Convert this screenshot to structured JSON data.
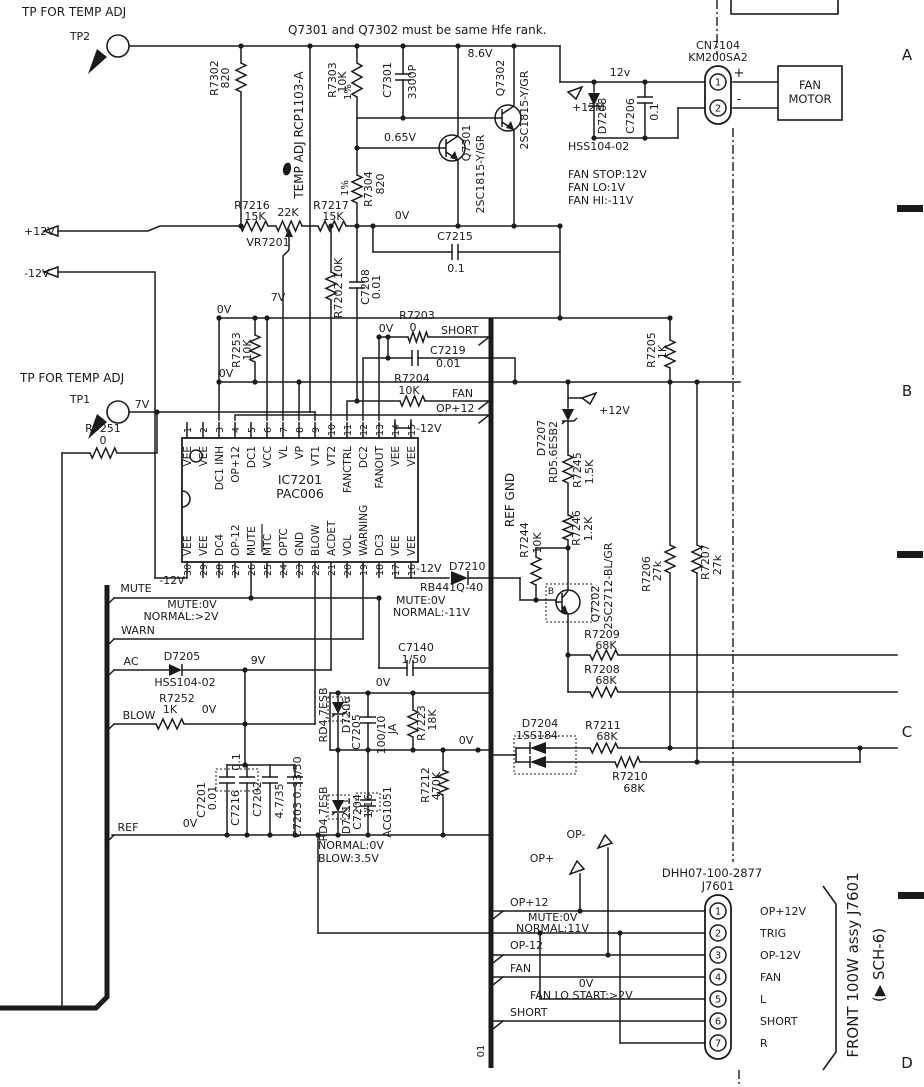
{
  "schematic": {
    "note": "Q7301 and Q7302 must be same Hfe rank.",
    "zones": [
      "A",
      "B",
      "C",
      "D"
    ]
  },
  "ic7201": {
    "ref": "IC7201",
    "part": "PAC006",
    "pin_numbers_top": [
      "1",
      "2",
      "3",
      "4",
      "5",
      "6",
      "7",
      "8",
      "9",
      "10",
      "11",
      "12",
      "13",
      "14",
      "15"
    ],
    "pins_top": [
      "VEE",
      "VEE",
      "DC1 INH",
      "OP+12",
      "DC1",
      "VCC",
      "VL",
      "VP",
      "VT1",
      "VT2",
      "FANCTRL",
      "DC2",
      "FANOUT",
      "VEE",
      "VEE"
    ],
    "pin_numbers_bottom": [
      "30",
      "29",
      "28",
      "27",
      "26",
      "25",
      "24",
      "23",
      "22",
      "21",
      "20",
      "19",
      "18",
      "17",
      "16"
    ],
    "pins_bottom": [
      "VEE",
      "VEE",
      "DC4",
      "OP-12",
      "MUTE",
      "MTC",
      "OPTC",
      "GND",
      "BLOW",
      "ACDET",
      "VOL",
      "WARNING",
      "DC3",
      "VEE",
      "VEE"
    ]
  },
  "connectors": {
    "cn7104": {
      "name": "CN7104",
      "part": "KM200SA2",
      "pins": [
        {
          "num": "1",
          "polarity": "+"
        },
        {
          "num": "2",
          "polarity": "-"
        }
      ],
      "load_lines": [
        "FAN",
        "MOTOR"
      ]
    },
    "j7601": {
      "name": "J7601",
      "part": "DHH07-100-2877",
      "pins": [
        {
          "num": "1",
          "label": "OP+12V"
        },
        {
          "num": "2",
          "label": "TRIG"
        },
        {
          "num": "3",
          "label": "OP-12V"
        },
        {
          "num": "4",
          "label": "FAN"
        },
        {
          "num": "5",
          "label": "L"
        },
        {
          "num": "6",
          "label": "SHORT"
        },
        {
          "num": "7",
          "label": "R"
        },
        {
          "num": "",
          "label": ""
        }
      ],
      "assy_note": "FRONT 100W assy J7601",
      "sch_ref": "(▶ SCH-6)"
    }
  },
  "labels": [
    {
      "name": "tp-top-caption",
      "text": "TP FOR TEMP ADJ",
      "x": 22,
      "y": 16,
      "a": "s",
      "s": 12
    },
    {
      "name": "tp2",
      "text": "TP2",
      "x": 80,
      "y": 40
    },
    {
      "name": "hfe-note",
      "text": "Q7301 and Q7302 must be same Hfe rank.",
      "x": 288,
      "y": 34,
      "a": "s",
      "s": 12
    },
    {
      "name": "r7302",
      "text": "R7302",
      "x": 218,
      "y": 78,
      "r": -90
    },
    {
      "name": "r7302-value",
      "text": "820",
      "x": 229,
      "y": 78,
      "r": -90
    },
    {
      "name": "temp-adj",
      "text": "TEMP ADJ RCP1103-A",
      "x": 303,
      "y": 135,
      "r": -90,
      "s": 12
    },
    {
      "name": "r7303",
      "text": "R7303",
      "x": 336,
      "y": 80,
      "r": -90
    },
    {
      "name": "r7303-value",
      "text": "10K",
      "x": 346,
      "y": 82,
      "r": -90
    },
    {
      "name": "r7303-tol",
      "text": "1%",
      "x": 351,
      "y": 92,
      "r": -90,
      "s": 10
    },
    {
      "name": "c7301",
      "text": "C7301",
      "x": 391,
      "y": 80,
      "r": -90
    },
    {
      "name": "c7301-value",
      "text": "3300P",
      "x": 416,
      "y": 82,
      "r": -90
    },
    {
      "name": "v-8-6",
      "text": "8.6V",
      "x": 480,
      "y": 57
    },
    {
      "name": "q7302",
      "text": "Q7302",
      "x": 504,
      "y": 78,
      "r": -90
    },
    {
      "name": "q7302-type",
      "text": "2SC1815-Y/GR",
      "x": 528,
      "y": 110,
      "r": -90
    },
    {
      "name": "v-0-65",
      "text": "0.65V",
      "x": 400,
      "y": 141
    },
    {
      "name": "q7301",
      "text": "Q7301",
      "x": 470,
      "y": 143,
      "r": -90
    },
    {
      "name": "q7301-type",
      "text": "2SC1815-Y/GR",
      "x": 484,
      "y": 174,
      "r": -90
    },
    {
      "name": "r7304-tol",
      "text": "1%",
      "x": 348,
      "y": 188,
      "r": -90,
      "s": 10
    },
    {
      "name": "r7304",
      "text": "R7304",
      "x": 372,
      "y": 189,
      "r": -90
    },
    {
      "name": "r7304-value",
      "text": "820",
      "x": 384,
      "y": 184,
      "r": -90
    },
    {
      "name": "v-0-top",
      "text": "0V",
      "x": 402,
      "y": 219
    },
    {
      "name": "c7215",
      "text": "C7215",
      "x": 455,
      "y": 240
    },
    {
      "name": "c7215-value",
      "text": "0.1",
      "x": 456,
      "y": 272
    },
    {
      "name": "p12m",
      "text": "+12M",
      "x": 572,
      "y": 111,
      "a": "s"
    },
    {
      "name": "d7208",
      "text": "D7208",
      "x": 606,
      "y": 116,
      "r": -90
    },
    {
      "name": "c7206",
      "text": "C7206",
      "x": 634,
      "y": 116,
      "r": -90
    },
    {
      "name": "c7206-value",
      "text": "0.1",
      "x": 658,
      "y": 112,
      "r": -90
    },
    {
      "name": "v-12v",
      "text": "12v",
      "x": 620,
      "y": 76
    },
    {
      "name": "hss104-top",
      "text": "HSS104-02",
      "x": 568,
      "y": 150,
      "a": "s"
    },
    {
      "name": "fan-stop",
      "text": "FAN STOP:12V",
      "x": 568,
      "y": 178,
      "a": "s"
    },
    {
      "name": "fan-lo",
      "text": "FAN LO:1V",
      "x": 568,
      "y": 191,
      "a": "s"
    },
    {
      "name": "fan-hi",
      "text": "FAN HI:-11V",
      "x": 568,
      "y": 204,
      "a": "s"
    },
    {
      "name": "p12v-feed",
      "text": "+12V",
      "x": 24,
      "y": 235,
      "a": "s"
    },
    {
      "name": "m12v-feed",
      "text": "-12V",
      "x": 24,
      "y": 277,
      "a": "s"
    },
    {
      "name": "r7216",
      "text": "R7216",
      "x": 252,
      "y": 209
    },
    {
      "name": "r7216-value",
      "text": "15K",
      "x": 255,
      "y": 220
    },
    {
      "name": "vr7201-value",
      "text": "22K",
      "x": 288,
      "y": 216
    },
    {
      "name": "vr7201",
      "text": "VR7201",
      "x": 268,
      "y": 246
    },
    {
      "name": "r7217",
      "text": "R7217",
      "x": 331,
      "y": 209
    },
    {
      "name": "r7217-value",
      "text": "15K",
      "x": 333,
      "y": 220
    },
    {
      "name": "r7202",
      "text": "R7202 10K",
      "x": 342,
      "y": 288,
      "r": -90
    },
    {
      "name": "c7208",
      "text": "C7208",
      "x": 369,
      "y": 287,
      "r": -90
    },
    {
      "name": "c7208-value",
      "text": "0.01",
      "x": 380,
      "y": 287,
      "r": -90
    },
    {
      "name": "v-7-mid",
      "text": "7V",
      "x": 278,
      "y": 301
    },
    {
      "name": "v-0-a",
      "text": "0V",
      "x": 224,
      "y": 313
    },
    {
      "name": "r7253",
      "text": "R7253",
      "x": 240,
      "y": 350,
      "r": -90
    },
    {
      "name": "r7253-value",
      "text": "10K",
      "x": 251,
      "y": 350,
      "r": -90
    },
    {
      "name": "v-0-b",
      "text": "0V",
      "x": 226,
      "y": 377
    },
    {
      "name": "tp-mid-caption",
      "text": "TP FOR TEMP ADJ",
      "x": 20,
      "y": 382,
      "a": "s",
      "s": 12
    },
    {
      "name": "tp1",
      "text": "TP1",
      "x": 80,
      "y": 403
    },
    {
      "name": "v-7-tp1",
      "text": "7V",
      "x": 142,
      "y": 408
    },
    {
      "name": "r7251",
      "text": "R7251",
      "x": 103,
      "y": 432
    },
    {
      "name": "r7251-value",
      "text": "0",
      "x": 103,
      "y": 444
    },
    {
      "name": "r7203",
      "text": "R7203",
      "x": 417,
      "y": 319
    },
    {
      "name": "r7203-value",
      "text": "0",
      "x": 413,
      "y": 331
    },
    {
      "name": "short-mid",
      "text": "SHORT",
      "x": 441,
      "y": 334,
      "a": "s"
    },
    {
      "name": "v-0-short",
      "text": "0V",
      "x": 386,
      "y": 332
    },
    {
      "name": "c7219",
      "text": "C7219",
      "x": 430,
      "y": 354,
      "a": "s"
    },
    {
      "name": "c7219-value",
      "text": "0.01",
      "x": 436,
      "y": 367,
      "a": "s"
    },
    {
      "name": "r7204",
      "text": "R7204",
      "x": 412,
      "y": 382
    },
    {
      "name": "r7204-value",
      "text": "10K",
      "x": 409,
      "y": 394
    },
    {
      "name": "fan-mid",
      "text": "FAN",
      "x": 452,
      "y": 397,
      "a": "s"
    },
    {
      "name": "op12-mid",
      "text": "OP+12",
      "x": 436,
      "y": 412,
      "a": "s"
    },
    {
      "name": "m12v-pins",
      "text": "-12V",
      "x": 416,
      "y": 432,
      "a": "s"
    },
    {
      "name": "r7205",
      "text": "R7205",
      "x": 655,
      "y": 350,
      "r": -90
    },
    {
      "name": "r7205-value",
      "text": "1K",
      "x": 666,
      "y": 352,
      "r": -90
    },
    {
      "name": "p12v-d7207",
      "text": "+12V",
      "x": 599,
      "y": 414,
      "a": "s"
    },
    {
      "name": "d7207",
      "text": "D7207",
      "x": 545,
      "y": 438,
      "r": -90
    },
    {
      "name": "d7207-type",
      "text": "RD5.6ESB2",
      "x": 557,
      "y": 452,
      "r": -90
    },
    {
      "name": "r7245",
      "text": "R7245",
      "x": 581,
      "y": 470,
      "r": -90
    },
    {
      "name": "r7245-value",
      "text": "1.5K",
      "x": 593,
      "y": 472,
      "r": -90
    },
    {
      "name": "r7246",
      "text": "R7246",
      "x": 580,
      "y": 528,
      "r": -90
    },
    {
      "name": "r7246-value",
      "text": "1.2K",
      "x": 592,
      "y": 529,
      "r": -90
    },
    {
      "name": "r7244",
      "text": "R7244",
      "x": 528,
      "y": 540,
      "r": -90
    },
    {
      "name": "r7244-value",
      "text": "10K",
      "x": 541,
      "y": 543,
      "r": -90
    },
    {
      "name": "ref-gnd",
      "text": "REF GND",
      "x": 514,
      "y": 500,
      "r": -90,
      "s": 12
    },
    {
      "name": "r7206",
      "text": "R7206",
      "x": 650,
      "y": 574,
      "r": -90
    },
    {
      "name": "r7206-value",
      "text": "27k",
      "x": 661,
      "y": 571,
      "r": -90
    },
    {
      "name": "r7207",
      "text": "R7207",
      "x": 709,
      "y": 562,
      "r": -90
    },
    {
      "name": "r7207-value",
      "text": "27k",
      "x": 721,
      "y": 565,
      "r": -90
    },
    {
      "name": "m12v-d7210",
      "text": "-12V",
      "x": 416,
      "y": 572,
      "a": "s"
    },
    {
      "name": "d7210",
      "text": "D7210",
      "x": 449,
      "y": 570,
      "a": "s"
    },
    {
      "name": "d7210-type",
      "text": "RB441Q-40",
      "x": 420,
      "y": 591,
      "a": "s"
    },
    {
      "name": "mute-0v-d7210",
      "text": "MUTE:0V",
      "x": 396,
      "y": 604,
      "a": "s"
    },
    {
      "name": "normal-m11v",
      "text": "NORMAL:-11V",
      "x": 393,
      "y": 616,
      "a": "s"
    },
    {
      "name": "q7202",
      "text": "Q7202",
      "x": 599,
      "y": 604,
      "r": -90
    },
    {
      "name": "q7202-type",
      "text": "2SC2712-BL/GR",
      "x": 612,
      "y": 586,
      "r": -90
    },
    {
      "name": "q7202-base",
      "text": "B",
      "x": 551,
      "y": 594,
      "s": 9
    },
    {
      "name": "c7140",
      "text": "C7140",
      "x": 416,
      "y": 651
    },
    {
      "name": "c7140-value",
      "text": "1/50",
      "x": 414,
      "y": 663
    },
    {
      "name": "r7209",
      "text": "R7209",
      "x": 602,
      "y": 638
    },
    {
      "name": "r7209-value",
      "text": "68K",
      "x": 606,
      "y": 649
    },
    {
      "name": "r7208",
      "text": "R7208",
      "x": 602,
      "y": 673
    },
    {
      "name": "r7208-value",
      "text": "68K",
      "x": 606,
      "y": 684
    },
    {
      "name": "m12v-ic",
      "text": "-12V",
      "x": 172,
      "y": 584
    },
    {
      "name": "mute-tag",
      "text": "MUTE",
      "x": 136,
      "y": 592
    },
    {
      "name": "mute-0v",
      "text": "MUTE:0V",
      "x": 192,
      "y": 608
    },
    {
      "name": "normal-2v",
      "text": "NORMAL:>2V",
      "x": 181,
      "y": 620
    },
    {
      "name": "warn-tag",
      "text": "WARN",
      "x": 138,
      "y": 634
    },
    {
      "name": "ac-tag",
      "text": "AC",
      "x": 131,
      "y": 665
    },
    {
      "name": "d7205",
      "text": "D7205",
      "x": 182,
      "y": 660
    },
    {
      "name": "hss104-mid",
      "text": "HSS104-02",
      "x": 185,
      "y": 686
    },
    {
      "name": "v-9",
      "text": "9V",
      "x": 258,
      "y": 664
    },
    {
      "name": "blow-tag",
      "text": "BLOW",
      "x": 139,
      "y": 719
    },
    {
      "name": "r7252",
      "text": "R7252",
      "x": 177,
      "y": 702
    },
    {
      "name": "r7252-value",
      "text": "1K",
      "x": 170,
      "y": 713
    },
    {
      "name": "v-0-r7252",
      "text": "0V",
      "x": 209,
      "y": 713
    },
    {
      "name": "v-0-rail",
      "text": "0V",
      "x": 383,
      "y": 686
    },
    {
      "name": "v-0-d7204",
      "text": "0V",
      "x": 466,
      "y": 744
    },
    {
      "name": "ref-tag",
      "text": "REF",
      "x": 128,
      "y": 831
    },
    {
      "name": "v-0-ref",
      "text": "0V",
      "x": 190,
      "y": 827
    },
    {
      "name": "normal-0v",
      "text": "NORMAL:0V",
      "x": 318,
      "y": 849,
      "a": "s"
    },
    {
      "name": "blow-3-5v",
      "text": "BLOW:3.5V",
      "x": 318,
      "y": 862,
      "a": "s"
    },
    {
      "name": "c7201",
      "text": "C7201",
      "x": 205,
      "y": 800,
      "r": -90
    },
    {
      "name": "c7201-value",
      "text": "0.01",
      "x": 216,
      "y": 798,
      "r": -90
    },
    {
      "name": "c7216",
      "text": "C7216",
      "x": 239,
      "y": 808,
      "r": -90
    },
    {
      "name": "c7216-value",
      "text": "0.1",
      "x": 240,
      "y": 762,
      "r": -90
    },
    {
      "name": "c7202",
      "text": "C7202",
      "x": 261,
      "y": 799,
      "r": -90
    },
    {
      "name": "c7202-value",
      "text": "4.7/35",
      "x": 283,
      "y": 801,
      "r": -90
    },
    {
      "name": "c7203",
      "text": "C7203 0.33/50",
      "x": 301,
      "y": 797,
      "r": -90
    },
    {
      "name": "d7206-type",
      "text": "RD4.7ESB",
      "x": 327,
      "y": 715,
      "r": -90
    },
    {
      "name": "d7206",
      "text": "D7206",
      "x": 350,
      "y": 715,
      "r": -90
    },
    {
      "name": "c7205",
      "text": "C7205",
      "x": 360,
      "y": 732,
      "r": -90
    },
    {
      "name": "c7205-value",
      "text": "100/10",
      "x": 385,
      "y": 735,
      "r": -90
    },
    {
      "name": "c7205-grade",
      "text": "JA",
      "x": 396,
      "y": 729,
      "r": -90
    },
    {
      "name": "r7223",
      "text": "R7223",
      "x": 425,
      "y": 723,
      "r": -90
    },
    {
      "name": "r7223-value",
      "text": "18K",
      "x": 436,
      "y": 720,
      "r": -90
    },
    {
      "name": "d7211-type",
      "text": "RD4.7ESB",
      "x": 327,
      "y": 814,
      "r": -90
    },
    {
      "name": "d7211",
      "text": "D7211",
      "x": 350,
      "y": 816,
      "r": -90
    },
    {
      "name": "c7204",
      "text": "C7204",
      "x": 361,
      "y": 812,
      "r": -90
    },
    {
      "name": "c7204-value",
      "text": "1/16",
      "x": 372,
      "y": 806,
      "r": -90
    },
    {
      "name": "acg1051",
      "text": "ACG1051",
      "x": 391,
      "y": 812,
      "r": -90
    },
    {
      "name": "r7212",
      "text": "R7212",
      "x": 429,
      "y": 785,
      "r": -90
    },
    {
      "name": "r7212-value",
      "text": "440,786",
      "x": 440,
      "y": 786,
      "r": -90
    },
    {
      "name": "d7204",
      "text": "D7204",
      "x": 540,
      "y": 727
    },
    {
      "name": "d7204-type",
      "text": "1SS184",
      "x": 537,
      "y": 739
    },
    {
      "name": "r7211",
      "text": "R7211",
      "x": 603,
      "y": 729
    },
    {
      "name": "r7211-value",
      "text": "68K",
      "x": 607,
      "y": 740
    },
    {
      "name": "r7210",
      "text": "R7210",
      "x": 630,
      "y": 780
    },
    {
      "name": "r7210-value",
      "text": "68K",
      "x": 634,
      "y": 792
    },
    {
      "name": "op-minus",
      "text": "OP-",
      "x": 576,
      "y": 838
    },
    {
      "name": "op-plus",
      "text": "OP+",
      "x": 542,
      "y": 862
    },
    {
      "name": "op12-bot",
      "text": "OP+12",
      "x": 510,
      "y": 906,
      "a": "s"
    },
    {
      "name": "mute-0v-bot",
      "text": "MUTE:0V",
      "x": 528,
      "y": 921,
      "a": "s"
    },
    {
      "name": "normal-11v",
      "text": "NORMAL:11V",
      "x": 516,
      "y": 932,
      "a": "s"
    },
    {
      "name": "op-12-bot",
      "text": "OP-12",
      "x": 510,
      "y": 949,
      "a": "s"
    },
    {
      "name": "fan-bot",
      "text": "FAN",
      "x": 510,
      "y": 972,
      "a": "s"
    },
    {
      "name": "v-0-fanlo",
      "text": "0V",
      "x": 586,
      "y": 987
    },
    {
      "name": "fan-lo-start",
      "text": "FAN LO START:>2V",
      "x": 530,
      "y": 999,
      "a": "s"
    },
    {
      "name": "short-bot",
      "text": "SHORT",
      "x": 510,
      "y": 1016,
      "a": "s"
    },
    {
      "name": "bus-01",
      "text": "01",
      "x": 484,
      "y": 1051,
      "r": -90,
      "s": 10
    }
  ]
}
